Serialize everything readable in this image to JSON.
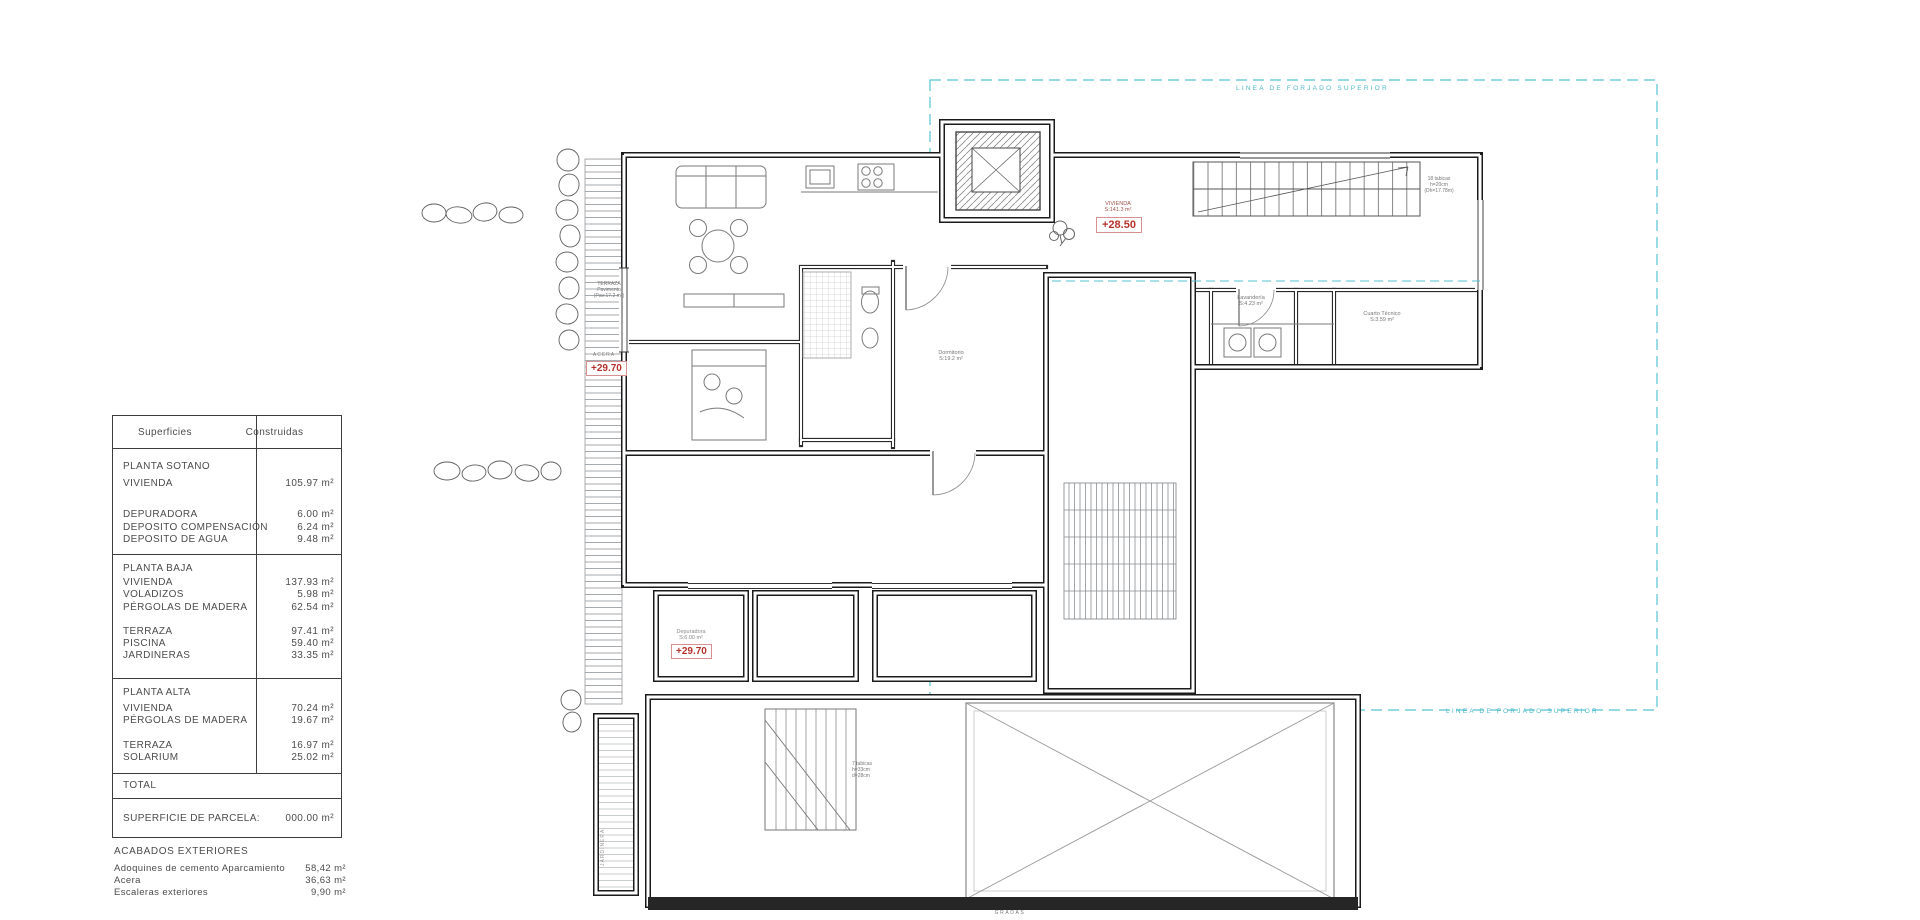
{
  "surfaces_table": {
    "header_col1": "Superficies",
    "header_col2": "Construidas",
    "sections": [
      {
        "rows": [
          {
            "label": "PLANTA SOTANO",
            "value": "",
            "mt": 0
          },
          {
            "label": "VIVIENDA",
            "value": "105.97 m²",
            "mt": 5
          },
          {
            "label": "DEPURADORA",
            "value": "6.00 m²",
            "mt": 19
          },
          {
            "label": "DEPOSITO COMPENSACIÓN",
            "value": "6.24 m²",
            "mt": 0
          },
          {
            "label": "DEPOSITO DE AGUA",
            "value": "9.48 m²",
            "mt": 0
          }
        ]
      },
      {
        "rows": [
          {
            "label": "PLANTA BAJA",
            "value": "",
            "mt": 0
          },
          {
            "label": "VIVIENDA",
            "value": "137.93 m²",
            "mt": 2
          },
          {
            "label": "VOLADIZOS",
            "value": "5.98 m²",
            "mt": 0
          },
          {
            "label": "PÉRGOLAS DE MADERA",
            "value": "62.54 m²",
            "mt": 0
          },
          {
            "label": "TERRAZA",
            "value": "97.41 m²",
            "mt": 12
          },
          {
            "label": "PISCINA",
            "value": "59.40 m²",
            "mt": 0
          },
          {
            "label": "JARDINERAS",
            "value": "33.35 m²",
            "mt": 0
          }
        ]
      },
      {
        "rows": [
          {
            "label": "PLANTA ALTA",
            "value": "",
            "mt": 0
          },
          {
            "label": "VIVIENDA",
            "value": "70.24 m²",
            "mt": 4
          },
          {
            "label": "PÉRGOLAS DE MADERA",
            "value": "19.67 m²",
            "mt": 0
          },
          {
            "label": "TERRAZA",
            "value": "16.97 m²",
            "mt": 12
          },
          {
            "label": "SOLARIUM",
            "value": "25.02 m²",
            "mt": 0
          }
        ]
      },
      {
        "rows": [
          {
            "label": "TOTAL",
            "value": "",
            "mt": 0
          }
        ]
      },
      {
        "rows": [
          {
            "label": "SUPERFICIE DE PARCELA:",
            "value": "000.00 m²",
            "mt": 0
          }
        ]
      }
    ]
  },
  "acabados": {
    "title": "ACABADOS EXTERIORES",
    "rows": [
      {
        "label": "Adoquines de cemento Aparcamiento",
        "value": "58,42 m²"
      },
      {
        "label": "Acera",
        "value": "36,63 m²"
      },
      {
        "label": "Escaleras exteriores",
        "value": "9,90 m²"
      }
    ]
  },
  "plan_labels": {
    "forjado_top": "LINEA DE FORJADO SUPERIOR",
    "forjado_bottom": "LINEA DE FORJADO SUPERIOR",
    "level_plus2850": "+28.50",
    "level_acera_value": "+29.70",
    "level_dep_value": "+29.70",
    "vivienda_l1": "VIVIENDA",
    "vivienda_l2": "S:141.3 m²",
    "acera": "ACERA",
    "dep_l1": "Depuradora",
    "dep_l2": "S:6.00 m²",
    "lav_l1": "Lavandería",
    "lav_l2": "S:4.23 m²",
    "cuarto_l1": "Cuarto Técnico",
    "cuarto_l2": "S:3.59 m²",
    "dorm_l1": "Dormitorio",
    "dorm_l2": "S:19.2 m²",
    "terraza_l1": "TERRAZA",
    "terraza_l2": "Pavimento",
    "terraza_l3": "(Pav:17.2 m²)",
    "stair18_l1": "18 tabicas",
    "stair18_l2": "h=20cm",
    "stair18_l3": "(Dh=17.78m)",
    "stair7_l1": "7 tabicas",
    "stair7_l2": "h=33cm",
    "stair7_l3": "d=28cm",
    "gradas": "GRADAS",
    "jardinera": "JARDINERA"
  },
  "colors": {
    "forjado_line": "#56c3d2",
    "level_red": "#b5322c",
    "wall": "#1b1b1b"
  }
}
